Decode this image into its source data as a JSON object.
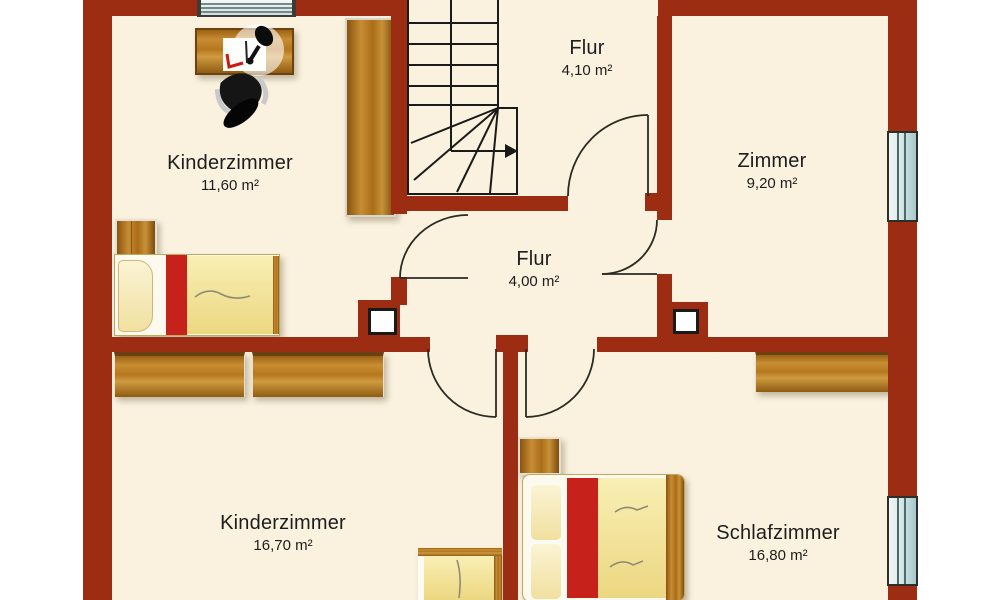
{
  "plan": {
    "rooms": [
      {
        "id": "kinderzimmer-top",
        "name": "Kinderzimmer",
        "area": "11,60 m²"
      },
      {
        "id": "flur-top",
        "name": "Flur",
        "area": "4,10 m²"
      },
      {
        "id": "zimmer",
        "name": "Zimmer",
        "area": "9,20 m²"
      },
      {
        "id": "flur-mid",
        "name": "Flur",
        "area": "4,00 m²"
      },
      {
        "id": "kinderzimmer-bottom",
        "name": "Kinderzimmer",
        "area": "16,70 m²"
      },
      {
        "id": "schlafzimmer",
        "name": "Schlafzimmer",
        "area": "16,80 m²"
      }
    ],
    "colors": {
      "wall": "#9c2d13",
      "floor": "#faf2df",
      "margin": "#ffffff",
      "bed_red": "#c6211a",
      "bed_yellow": "#f0e09a",
      "wood": "#b5771e",
      "window_blue": "#cfe3e3",
      "line": "#1d1d1d"
    },
    "icons": {
      "stairs": "stairs-up-arrow-icon",
      "doors": "door-swing-icon",
      "chimney": "chimney-shaft-icon"
    }
  }
}
